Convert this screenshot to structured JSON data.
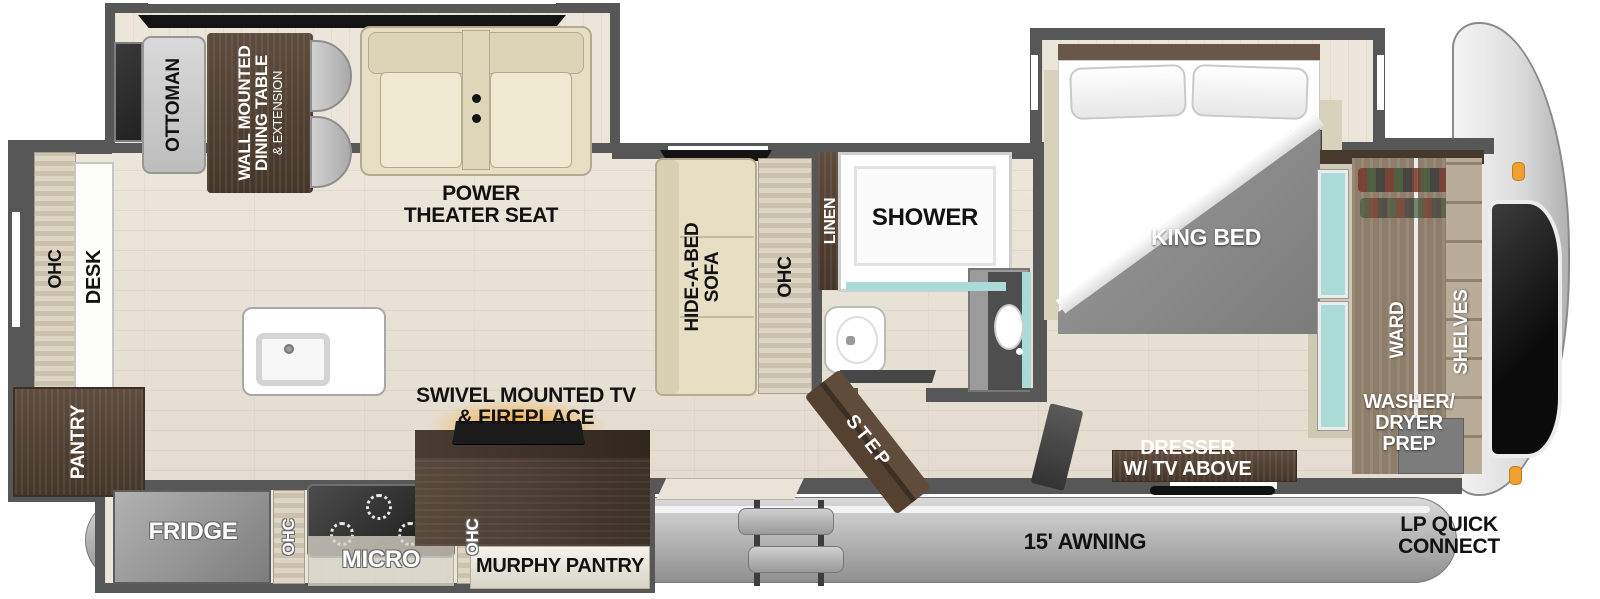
{
  "title": "Fifth Wheel RV Floor Plan",
  "colors": {
    "wall": "#575757",
    "floor_wood": "#eae4d9",
    "dark_wood": "#5e4c3e",
    "beige_furniture": "#e6dfc4",
    "teal_accent": "#aadbd6",
    "fireplace_glow": "#f5a623",
    "marker_light": "#f0a030"
  },
  "labels": {
    "ottoman": "OTTOMAN",
    "dining": [
      "WALL MOUNTED",
      "DINING TABLE",
      "& EXTENSION"
    ],
    "theater": [
      "POWER",
      "THEATER SEAT"
    ],
    "sofa": [
      "HIDE-A-BED",
      "SOFA"
    ],
    "ohc": "OHC",
    "linen": "LINEN",
    "shower": "SHOWER",
    "king_bed": "KING BED",
    "ward": "WARD",
    "shelves": "SHELVES",
    "washer_dryer": [
      "WASHER/",
      "DRYER",
      "PREP"
    ],
    "dresser": [
      "DRESSER",
      "W/ TV ABOVE"
    ],
    "step": "STEP",
    "desk": "DESK",
    "pantry": "PANTRY",
    "fridge": "FRIDGE",
    "micro": "MICRO",
    "murphy_pantry": "MURPHY PANTRY",
    "tv_fireplace": [
      "SWIVEL MOUNTED TV",
      "& FIREPLACE"
    ],
    "awning": "15' AWNING",
    "lp_quick_connect": [
      "LP QUICK",
      "CONNECT"
    ]
  }
}
